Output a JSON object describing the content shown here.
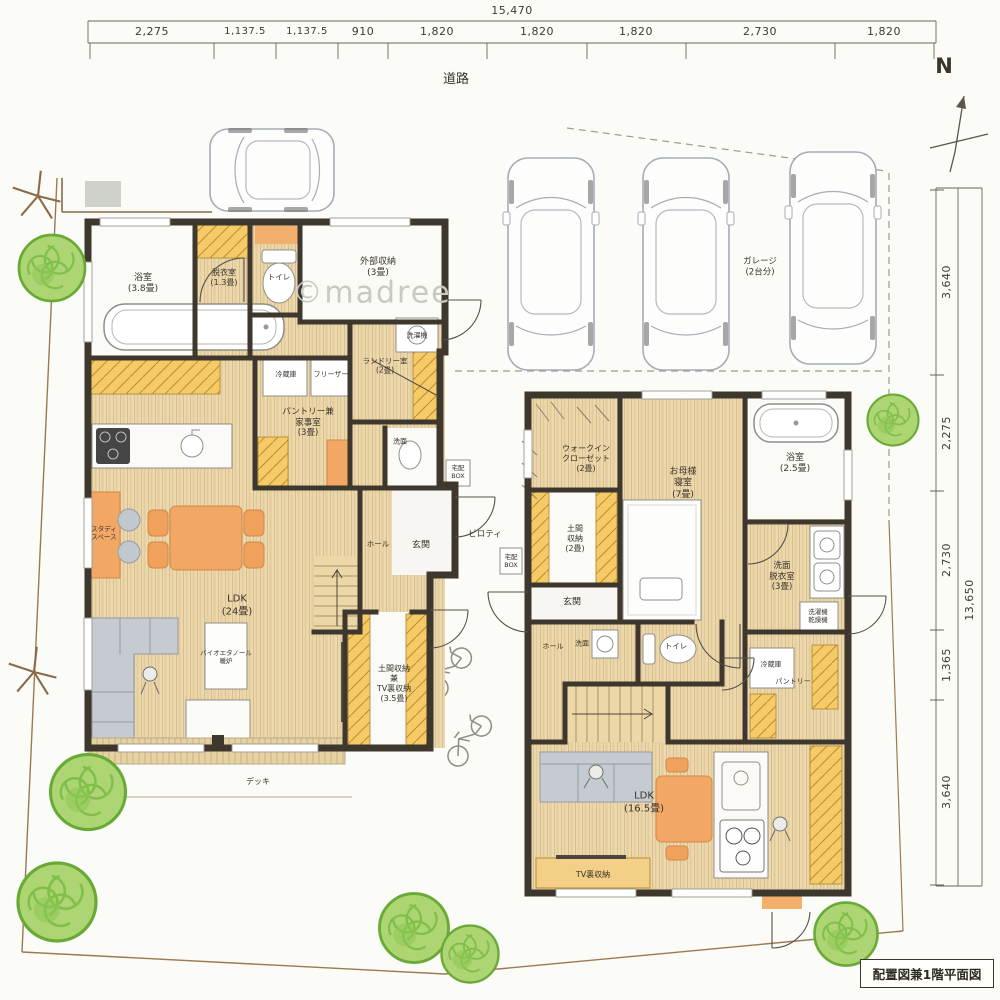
{
  "drawing": {
    "title": "配置図兼1階平面図",
    "watermark": "©madree",
    "north": "N",
    "road": "道路"
  },
  "dimensions": {
    "top": {
      "total": "15,470",
      "segments": [
        "2,275",
        "1,137.5",
        "1,137.5",
        "910",
        "1,820",
        "1,820",
        "1,820",
        "2,730",
        "1,820"
      ]
    },
    "right": {
      "total": "13,650",
      "segments": [
        "3,640",
        "2,275",
        "2,730",
        "1,365",
        "3,640"
      ]
    }
  },
  "site": {
    "garage": "ガレージ\n(2台分)",
    "piloti": "ピロティ",
    "deck": "デッキ"
  },
  "house_west": {
    "bath": "浴室\n(3.8畳)",
    "dressing": "脱衣室\n(1.3畳)",
    "toilet": "トイレ",
    "exterior_storage": "外部収納\n(3畳)",
    "washer": "洗濯機",
    "laundry": "ランドリー室\n(2畳)",
    "fridge": "冷蔵庫",
    "freezer": "フリーザー",
    "pantry_workroom": "パントリー兼\n家事室\n(3畳)",
    "vanity": "洗面",
    "delivery_box": "宅配\nBOX",
    "hall": "ホール",
    "entrance": "玄関",
    "study": "スタディ\nスペース",
    "ldk": "LDK\n(24畳)",
    "fireplace": "バイオエタノール\n暖炉",
    "doma_tv_storage": "土間収納\n兼\nTV裏収納\n(3.5畳)"
  },
  "house_east": {
    "wic": "ウォークイン\nクローゼット\n(2畳)",
    "mother_bedroom": "お母様\n寝室\n(7畳)",
    "bath": "浴室\n(2.5畳)",
    "doma_storage": "土間\n収納\n(2畳)",
    "delivery_box": "宅配\nBOX",
    "entrance": "玄関",
    "hall": "ホール",
    "vanity": "洗面",
    "toilet": "トイレ",
    "laundry_room": "洗面\n脱衣室\n(3畳)",
    "washer_dryer": "洗濯機\n乾燥機",
    "fridge": "冷蔵庫",
    "pantry": "パントリー",
    "ldk": "LDK\n(16.5畳)",
    "tv_storage": "TV裏収納"
  }
}
